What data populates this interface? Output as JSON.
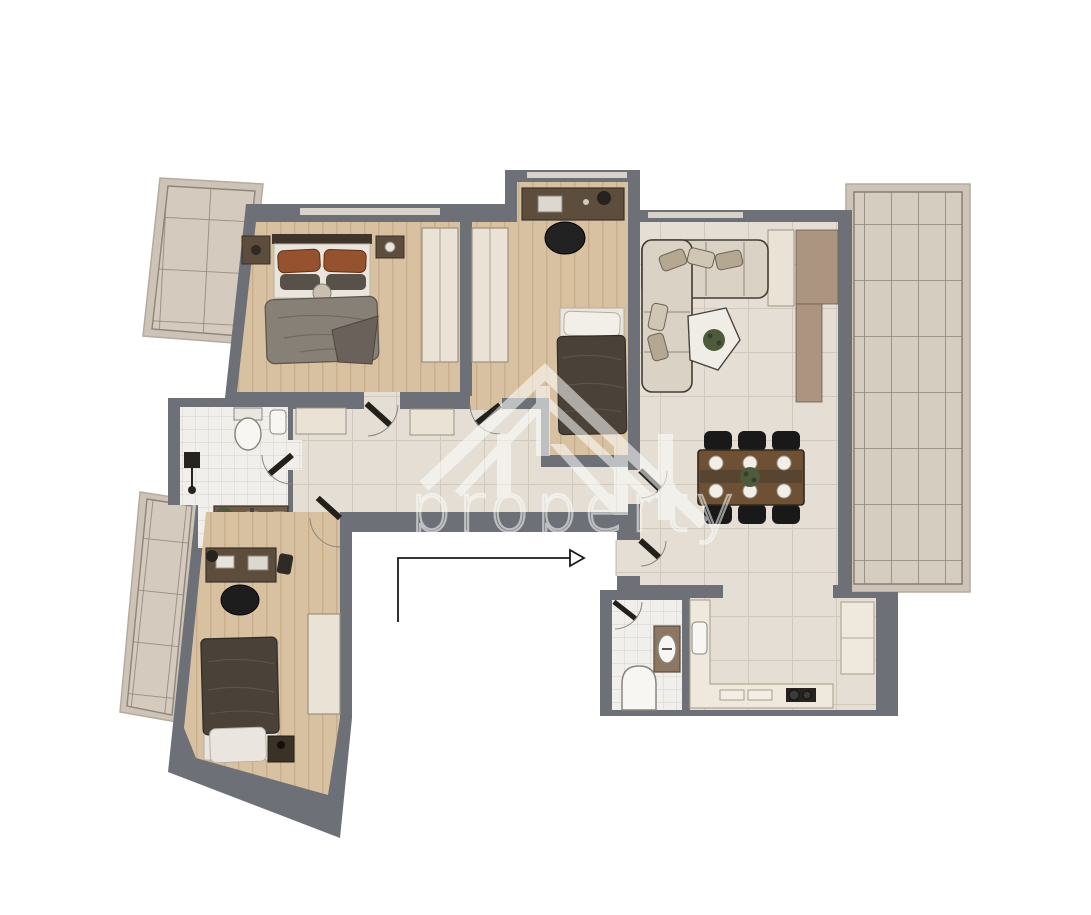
{
  "watermark": {
    "text": "property",
    "logo": "house-roof-monogram"
  },
  "entrance": {
    "indicator": "l-shaped-arrow",
    "direction": "right"
  },
  "colors": {
    "wall": "#6d7177",
    "background": "#ffffff",
    "floor_wood": "#d8c1a0",
    "floor_wood_line": "#c8ae8b",
    "tile_hall": "#e4ded4",
    "tile_hall_grout": "#cfc8bb",
    "tile_bath": "#f1efeb",
    "tile_bath_grout": "#dbd7d1",
    "tile_balcony": "#d4cabe",
    "tile_balcony_grout": "#8e8578",
    "balcony_frame": "#cdc4b7",
    "terrace_tile": "#d6cdc1",
    "terrace_grout": "#8d8478",
    "closet_cream": "#eae2d4",
    "closet_outline": "#9a9183",
    "wood_dark": "#5d4d3c",
    "sofa_beige": "#d9d2c5",
    "sofa_outline": "#433d35",
    "pillow_rust": "#96522f",
    "pillow_gray": "#57514a",
    "blanket_gray": "#878076",
    "blanket_dark": "#4a4238",
    "bed_white": "#eae6de",
    "table_brown": "#6e5134",
    "chair_black": "#191919",
    "media_tan": "#ab9480",
    "counter_cream": "#efe8dc",
    "plant_green": "#4d5a3b",
    "fixture_white": "#f7f6f3",
    "fixture_outline": "#8a857c",
    "arrow_black": "#1a1a1a",
    "watermark_white": "#ffffff"
  },
  "scene": {
    "type": "apartment-floor-plan-top-view",
    "rooms": [
      {
        "name": "master-bedroom",
        "floor": "wood",
        "furniture": [
          "double-bed",
          "nightstand-left",
          "nightstand-right",
          "wardrobe"
        ]
      },
      {
        "name": "bedroom-2",
        "floor": "wood",
        "furniture": [
          "desk",
          "office-chair",
          "single-bed",
          "wardrobe"
        ]
      },
      {
        "name": "living-dining-room",
        "floor": "tile",
        "furniture": [
          "corner-sofa",
          "coffee-table",
          "dining-table",
          "six-chairs",
          "media-wall",
          "closet"
        ]
      },
      {
        "name": "hallway",
        "floor": "tile",
        "furniture": [
          "sideboard",
          "sideboard"
        ]
      },
      {
        "name": "bathroom-1",
        "floor": "tile",
        "furniture": [
          "toilet",
          "wall-sink",
          "vanity-basin",
          "floor-lamp",
          "plant"
        ]
      },
      {
        "name": "bedroom-3",
        "floor": "wood",
        "furniture": [
          "desk",
          "office-chair",
          "single-bed",
          "wardrobe",
          "nightstand"
        ]
      },
      {
        "name": "bathroom-2",
        "floor": "tile",
        "furniture": [
          "sink-console",
          "toilet"
        ]
      },
      {
        "name": "kitchen",
        "floor": "tile",
        "furniture": [
          "l-counter",
          "sink",
          "cooktop",
          "tall-unit"
        ]
      },
      {
        "name": "balcony-upper-left",
        "floor": "balcony-tile"
      },
      {
        "name": "balcony-lower-left",
        "floor": "balcony-tile"
      },
      {
        "name": "terrace-right",
        "floor": "terrace-tile"
      }
    ],
    "door_count": 7
  }
}
